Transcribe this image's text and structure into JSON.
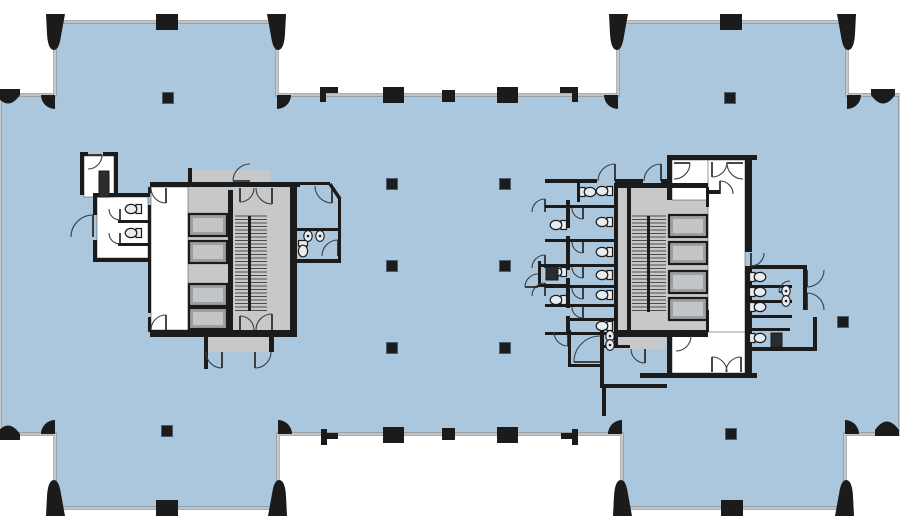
{
  "canvas": {
    "w": 900,
    "h": 530
  },
  "colors": {
    "background": "#ffffff",
    "floor_blue": "#aac7de",
    "curtain_wall_gray": "#8e9396",
    "curtain_wall_inner": "#f4f6f7",
    "wall_black": "#1b1b1b",
    "core_gray": "#c6c8c9",
    "elevator_car": "#9da0a2",
    "elevator_car_inner": "#c3c5c7",
    "stair_tread": "#4a4c4e",
    "room_white": "#ffffff",
    "fixture_fill": "#e8edf2",
    "fixture_dark": "#2a2c2e"
  },
  "floor": {
    "outline": [
      [
        0,
        95
      ],
      [
        55,
        95
      ],
      [
        55,
        22
      ],
      [
        277,
        22
      ],
      [
        277,
        95
      ],
      [
        618,
        95
      ],
      [
        618,
        22
      ],
      [
        847,
        22
      ],
      [
        847,
        95
      ],
      [
        900,
        95
      ],
      [
        900,
        434
      ],
      [
        845,
        434
      ],
      [
        845,
        508
      ],
      [
        622,
        508
      ],
      [
        622,
        434
      ],
      [
        278,
        434
      ],
      [
        278,
        508
      ],
      [
        55,
        508
      ],
      [
        55,
        434
      ],
      [
        0,
        434
      ]
    ]
  },
  "gray_rects": [
    [
      188,
      187,
      40,
      143
    ],
    [
      233,
      187,
      36,
      143
    ],
    [
      269,
      187,
      21,
      143
    ],
    [
      192,
      170,
      78,
      13
    ],
    [
      205,
      337,
      68,
      15
    ],
    [
      618,
      183,
      49,
      17
    ],
    [
      618,
      183,
      12,
      162
    ],
    [
      631,
      187,
      37,
      145
    ],
    [
      668,
      187,
      40,
      145
    ],
    [
      620,
      337,
      46,
      12
    ]
  ],
  "white_rects": [
    [
      151,
      187,
      37,
      143
    ],
    [
      97,
      197,
      51,
      61
    ],
    [
      84,
      156,
      30,
      41
    ],
    [
      672,
      160,
      73,
      40
    ],
    [
      708,
      160,
      37,
      215
    ],
    [
      672,
      332,
      73,
      41
    ]
  ],
  "stairs": [
    {
      "bg": [
        233,
        187,
        36,
        143
      ],
      "treads": [
        235,
        216,
        32,
        95
      ],
      "divider": [
        248,
        216,
        3,
        95
      ]
    },
    {
      "bg": [
        631,
        187,
        37,
        145
      ],
      "treads": [
        632,
        216,
        34,
        96
      ],
      "divider": [
        647,
        216,
        3,
        96
      ]
    }
  ],
  "elevator_cars": [
    [
      189,
      214,
      38,
      22
    ],
    [
      189,
      241,
      38,
      22
    ],
    [
      189,
      284,
      38,
      22
    ],
    [
      189,
      308,
      38,
      21
    ],
    [
      669,
      215,
      38,
      22
    ],
    [
      669,
      242,
      38,
      22
    ],
    [
      669,
      271,
      38,
      22
    ],
    [
      669,
      298,
      38,
      22
    ]
  ],
  "walls": [
    [
      150,
      182,
      150,
      5
    ],
    [
      297,
      182,
      33,
      3
    ],
    [
      338,
      198,
      3,
      64
    ],
    [
      297,
      259,
      44,
      4
    ],
    [
      297,
      228,
      41,
      3
    ],
    [
      150,
      330,
      147,
      7
    ],
    [
      204,
      337,
      4,
      32
    ],
    [
      269,
      337,
      5,
      15
    ],
    [
      148,
      187,
      3,
      6
    ],
    [
      148,
      205,
      3,
      108
    ],
    [
      148,
      317,
      3,
      15
    ],
    [
      228,
      190,
      5,
      140
    ],
    [
      290,
      182,
      7,
      155
    ],
    [
      188,
      168,
      4,
      16
    ],
    [
      80,
      152,
      4,
      43
    ],
    [
      80,
      152,
      8,
      4
    ],
    [
      103,
      152,
      15,
      4
    ],
    [
      114,
      152,
      4,
      43
    ],
    [
      93,
      193,
      57,
      4
    ],
    [
      93,
      193,
      4,
      22
    ],
    [
      93,
      240,
      4,
      22
    ],
    [
      93,
      258,
      57,
      4
    ],
    [
      118,
      220,
      30,
      3
    ],
    [
      118,
      243,
      30,
      3
    ],
    [
      545,
      179,
      52,
      4
    ],
    [
      615,
      179,
      28,
      4
    ],
    [
      661,
      179,
      6,
      4
    ],
    [
      667,
      155,
      5,
      45
    ],
    [
      667,
      155,
      90,
      5
    ],
    [
      614,
      183,
      4,
      162
    ],
    [
      566,
      200,
      4,
      28
    ],
    [
      566,
      236,
      4,
      34
    ],
    [
      566,
      278,
      4,
      30
    ],
    [
      566,
      316,
      4,
      16
    ],
    [
      545,
      205,
      69,
      3
    ],
    [
      545,
      239,
      69,
      3
    ],
    [
      538,
      264,
      76,
      3
    ],
    [
      545,
      285,
      69,
      3
    ],
    [
      545,
      304,
      69,
      3
    ],
    [
      566,
      318,
      48,
      3
    ],
    [
      545,
      332,
      69,
      3
    ],
    [
      538,
      261,
      3,
      26
    ],
    [
      538,
      284,
      28,
      3
    ],
    [
      627,
      187,
      4,
      145
    ],
    [
      615,
      183,
      93,
      5
    ],
    [
      615,
      330,
      93,
      7
    ],
    [
      706,
      187,
      3,
      20
    ],
    [
      706,
      310,
      3,
      22
    ],
    [
      745,
      155,
      7,
      97
    ],
    [
      745,
      266,
      7,
      109
    ],
    [
      708,
      190,
      12,
      4
    ],
    [
      667,
      332,
      5,
      45
    ],
    [
      640,
      373,
      117,
      5
    ],
    [
      568,
      330,
      3,
      37
    ],
    [
      568,
      364,
      32,
      3
    ],
    [
      600,
      330,
      4,
      58
    ],
    [
      600,
      384,
      67,
      4
    ],
    [
      602,
      388,
      4,
      28
    ],
    [
      604,
      345,
      26,
      3
    ],
    [
      577,
      183,
      3,
      19
    ],
    [
      752,
      265,
      55,
      4
    ],
    [
      752,
      285,
      40,
      3
    ],
    [
      752,
      300,
      40,
      3
    ],
    [
      752,
      315,
      40,
      3
    ],
    [
      752,
      328,
      38,
      3
    ],
    [
      803,
      265,
      4,
      45
    ],
    [
      752,
      347,
      65,
      4
    ],
    [
      813,
      317,
      4,
      34
    ],
    [
      156,
      14,
      22,
      16
    ],
    [
      720,
      14,
      22,
      16
    ],
    [
      383,
      87,
      21,
      16
    ],
    [
      497,
      87,
      21,
      16
    ],
    [
      442,
      90,
      13,
      12
    ],
    [
      383,
      427,
      21,
      16
    ],
    [
      497,
      427,
      21,
      16
    ],
    [
      442,
      428,
      13,
      12
    ],
    [
      156,
      500,
      22,
      16
    ],
    [
      721,
      500,
      22,
      16
    ],
    [
      320,
      87,
      6,
      15
    ],
    [
      320,
      87,
      18,
      6
    ],
    [
      560,
      87,
      18,
      6
    ],
    [
      572,
      87,
      6,
      15
    ],
    [
      321,
      429,
      6,
      16
    ],
    [
      321,
      433,
      17,
      6
    ],
    [
      561,
      433,
      17,
      6
    ],
    [
      572,
      429,
      6,
      16
    ]
  ],
  "chamfer_lines": [
    [
      330,
      184,
      340,
      199
    ]
  ],
  "interior_columns": [
    [
      168,
      98
    ],
    [
      730,
      98
    ],
    [
      392,
      184
    ],
    [
      505,
      184
    ],
    [
      392,
      266
    ],
    [
      505,
      266
    ],
    [
      392,
      348
    ],
    [
      505,
      348
    ],
    [
      843,
      322
    ],
    [
      167,
      431
    ],
    [
      731,
      434
    ]
  ],
  "corner_boots": [
    [
      55,
      22,
      1,
      1
    ],
    [
      277,
      22,
      -1,
      1
    ],
    [
      618,
      22,
      1,
      1
    ],
    [
      847,
      22,
      -1,
      1
    ],
    [
      55,
      508,
      1,
      -1
    ],
    [
      278,
      508,
      -1,
      -1
    ],
    [
      622,
      508,
      1,
      -1
    ],
    [
      845,
      508,
      -1,
      -1
    ]
  ],
  "corner_fans": [
    [
      55,
      95,
      -1,
      1
    ],
    [
      277,
      95,
      1,
      1
    ],
    [
      618,
      95,
      -1,
      1
    ],
    [
      847,
      95,
      1,
      1
    ],
    [
      55,
      434,
      -1,
      -1
    ],
    [
      278,
      434,
      1,
      -1
    ],
    [
      622,
      434,
      -1,
      -1
    ],
    [
      845,
      434,
      1,
      -1
    ]
  ],
  "edge_bumps": [
    [
      883,
      95,
      1
    ],
    [
      8,
      95,
      1
    ],
    [
      887,
      430,
      -1
    ],
    [
      8,
      434,
      -1
    ]
  ],
  "doors": [
    [
      93,
      237,
      22,
      270,
      180
    ],
    [
      120,
      209,
      11,
      90,
      180
    ],
    [
      120,
      233,
      11,
      90,
      180
    ],
    [
      88,
      155,
      14,
      0,
      90
    ],
    [
      250,
      181,
      17,
      180,
      270
    ],
    [
      166,
      188,
      15,
      90,
      180
    ],
    [
      166,
      330,
      15,
      270,
      180
    ],
    [
      240,
      188,
      14,
      90,
      0
    ],
    [
      240,
      330,
      14,
      270,
      0
    ],
    [
      272,
      188,
      16,
      90,
      180
    ],
    [
      272,
      330,
      16,
      270,
      180
    ],
    [
      222,
      352,
      16,
      90,
      180
    ],
    [
      255,
      352,
      16,
      90,
      0
    ],
    [
      332,
      186,
      17,
      90,
      180
    ],
    [
      338,
      256,
      16,
      270,
      180
    ],
    [
      615,
      181,
      17,
      270,
      180
    ],
    [
      661,
      181,
      17,
      270,
      180
    ],
    [
      674,
      163,
      16,
      0,
      90
    ],
    [
      743,
      163,
      16,
      180,
      90
    ],
    [
      545,
      212,
      13,
      270,
      180
    ],
    [
      545,
      268,
      13,
      270,
      180
    ],
    [
      545,
      296,
      13,
      270,
      180
    ],
    [
      538,
      287,
      13,
      180,
      270
    ],
    [
      583,
      208,
      11,
      90,
      180
    ],
    [
      583,
      242,
      11,
      90,
      180
    ],
    [
      583,
      267,
      11,
      90,
      180
    ],
    [
      583,
      288,
      11,
      90,
      180
    ],
    [
      583,
      307,
      11,
      90,
      180
    ],
    [
      712,
      162,
      15,
      90,
      0
    ],
    [
      720,
      194,
      13,
      270,
      0
    ],
    [
      712,
      372,
      15,
      270,
      0
    ],
    [
      741,
      372,
      15,
      270,
      180
    ],
    [
      751,
      253,
      13,
      90,
      0
    ],
    [
      676,
      336,
      15,
      0,
      90
    ],
    [
      600,
      362,
      26,
      180,
      270
    ],
    [
      568,
      332,
      14,
      90,
      180
    ],
    [
      645,
      349,
      14,
      90,
      180
    ],
    [
      807,
      270,
      17,
      90,
      0
    ],
    [
      807,
      310,
      17,
      270,
      0
    ],
    [
      790,
      292,
      11,
      180,
      270
    ]
  ],
  "toilets": [
    [
      133,
      209,
      180
    ],
    [
      133,
      233,
      180
    ],
    [
      303,
      249,
      90
    ],
    [
      558,
      225,
      180
    ],
    [
      558,
      272,
      180
    ],
    [
      558,
      300,
      180
    ],
    [
      604,
      191,
      180
    ],
    [
      604,
      222,
      180
    ],
    [
      604,
      252,
      180
    ],
    [
      604,
      275,
      180
    ],
    [
      604,
      295,
      180
    ],
    [
      604,
      326,
      180
    ],
    [
      588,
      192,
      0
    ],
    [
      758,
      277,
      0
    ],
    [
      758,
      292,
      0
    ],
    [
      758,
      307,
      0
    ],
    [
      758,
      338,
      0
    ]
  ],
  "sinks": [
    [
      308,
      236
    ],
    [
      320,
      236
    ],
    [
      786,
      291
    ],
    [
      786,
      301
    ],
    [
      610,
      336
    ],
    [
      610,
      345
    ]
  ],
  "fixture_rects": [
    [
      99,
      171,
      10,
      26
    ],
    [
      546,
      267,
      12,
      13
    ],
    [
      771,
      333,
      11,
      14
    ]
  ]
}
